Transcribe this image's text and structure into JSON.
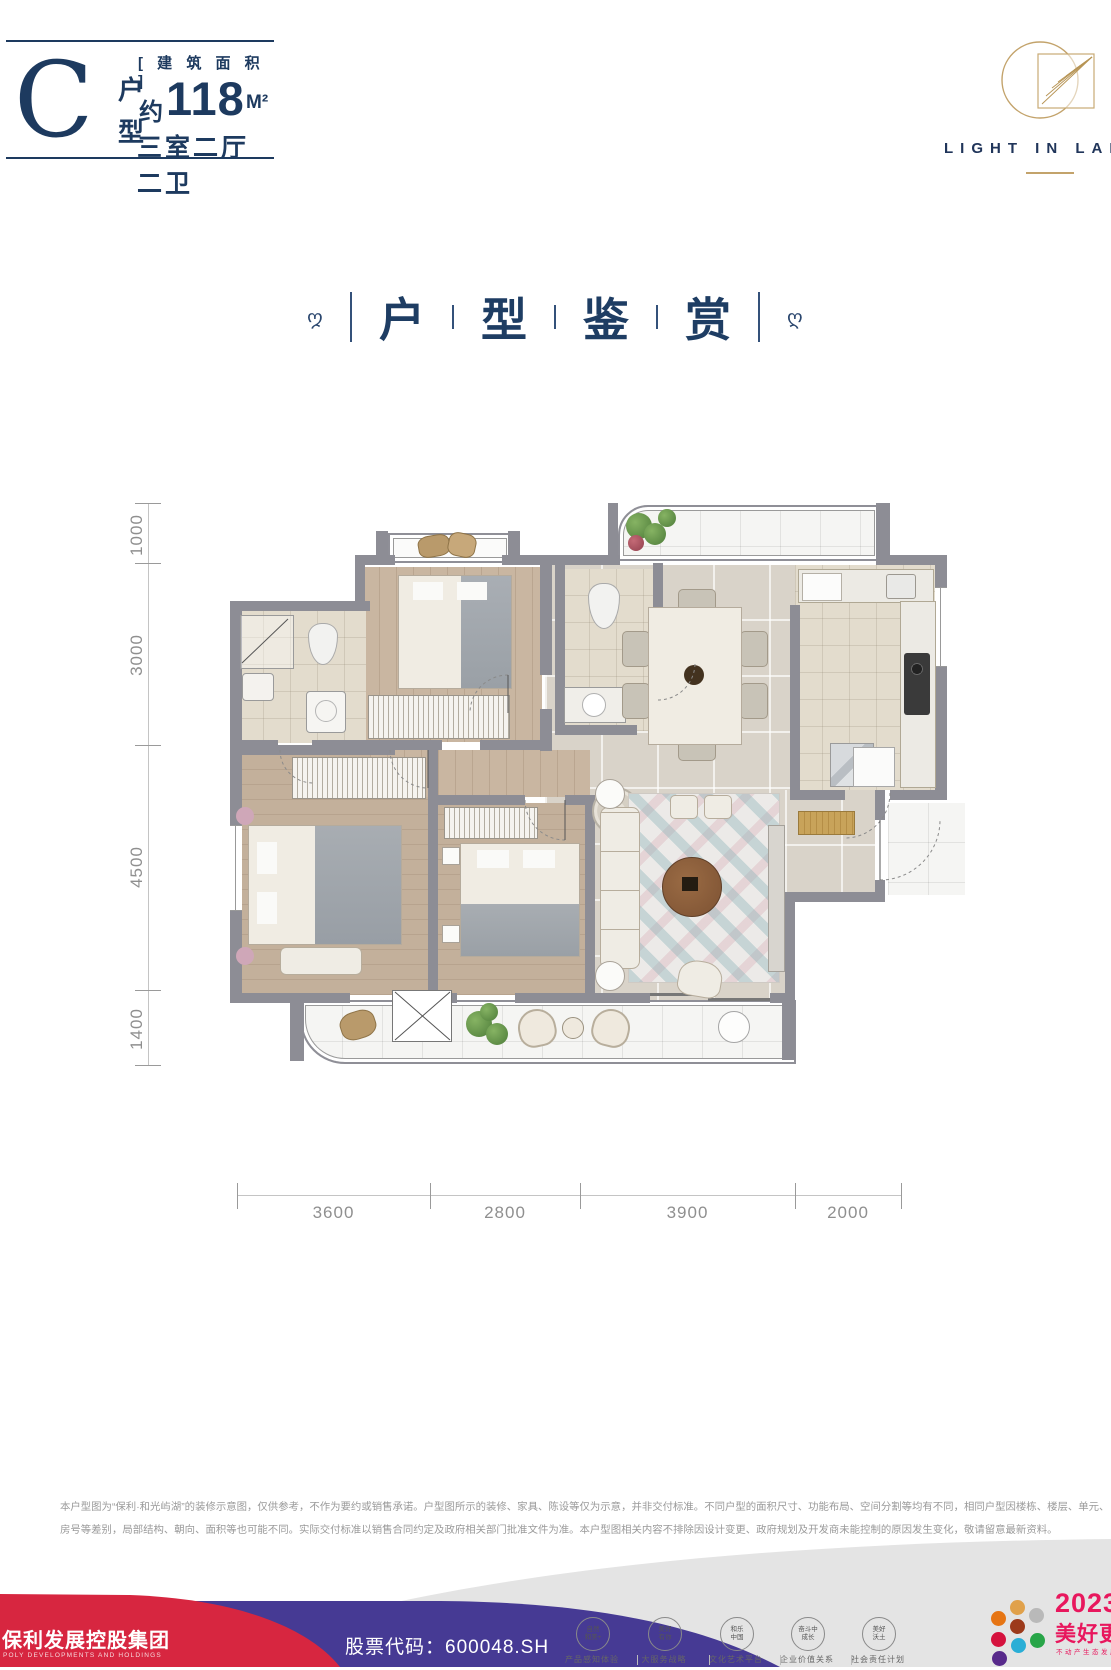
{
  "header": {
    "type_letter": "C",
    "type_label_top": "户",
    "type_label_bottom": "型",
    "area_tag": "[ 建 筑 面 积 ]",
    "area_prefix": "约",
    "area_value": "118",
    "area_unit": "M²",
    "layout_desc": "三室二厅二卫"
  },
  "brand": {
    "logo_text": "LIGHT IN LAKE"
  },
  "section_title": {
    "chars": [
      "户",
      "型",
      "鉴",
      "赏"
    ]
  },
  "plan": {
    "dims_left": [
      "1000",
      "3000",
      "4500",
      "1400"
    ],
    "dims_bottom": [
      "3600",
      "2800",
      "3900",
      "2000"
    ]
  },
  "disclaimer": {
    "line1": "本户型图为“保利·和光屿湖”的装修示意图，仅供参考，不作为要约或销售承诺。户型图所示的装修、家具、陈设等仅为示意，并非交付标准。不同户型的面积尺寸、功能布局、空间分割等均有不同，相同户型因楼栋、楼层、单元、",
    "line2": "房号等差别，局部结构、朝向、面积等也可能不同。实际交付标准以销售合同约定及政府相关部门批准文件为准。本户型图相关内容不排除因设计变更、政府规划及开发商未能控制的原因发生变化，敬请留意最新资料。"
  },
  "footer": {
    "company": "保利发展控股集团",
    "company_en": "POLY DEVELOPMENTS AND HOLDINGS",
    "stock": "股票代码：600048.SH",
    "badges": [
      {
        "l1": "自然",
        "l2": "和美+",
        "caption": "产品感知体验"
      },
      {
        "l1": "美好",
        "l2": "有你",
        "caption": "大服务战略"
      },
      {
        "l1": "和乐",
        "l2": "中国",
        "caption": "文化艺术平台"
      },
      {
        "l1": "奋斗中",
        "l2": "成长",
        "caption": "企业价值关系"
      },
      {
        "l1": "美好",
        "l2": "沃土",
        "caption": "社会责任计划"
      }
    ],
    "campaign_year": "2023",
    "campaign_text": "美好更新",
    "campaign_sub": "不动产生态发展平台",
    "dot_colors": [
      "#e0a14b",
      "#e67514",
      "#b9b9b9",
      "#9c3a1b",
      "#d5123d",
      "#28a548",
      "#2aaed6",
      "#582a8b"
    ]
  },
  "colors": {
    "accent_navy": "#1d3a5f",
    "brand_gold": "#c3a36b",
    "footer_red": "#d72640",
    "footer_purple": "#463a94",
    "campaign_pink": "#e8175d",
    "wall_gray": "#8d8d95"
  }
}
